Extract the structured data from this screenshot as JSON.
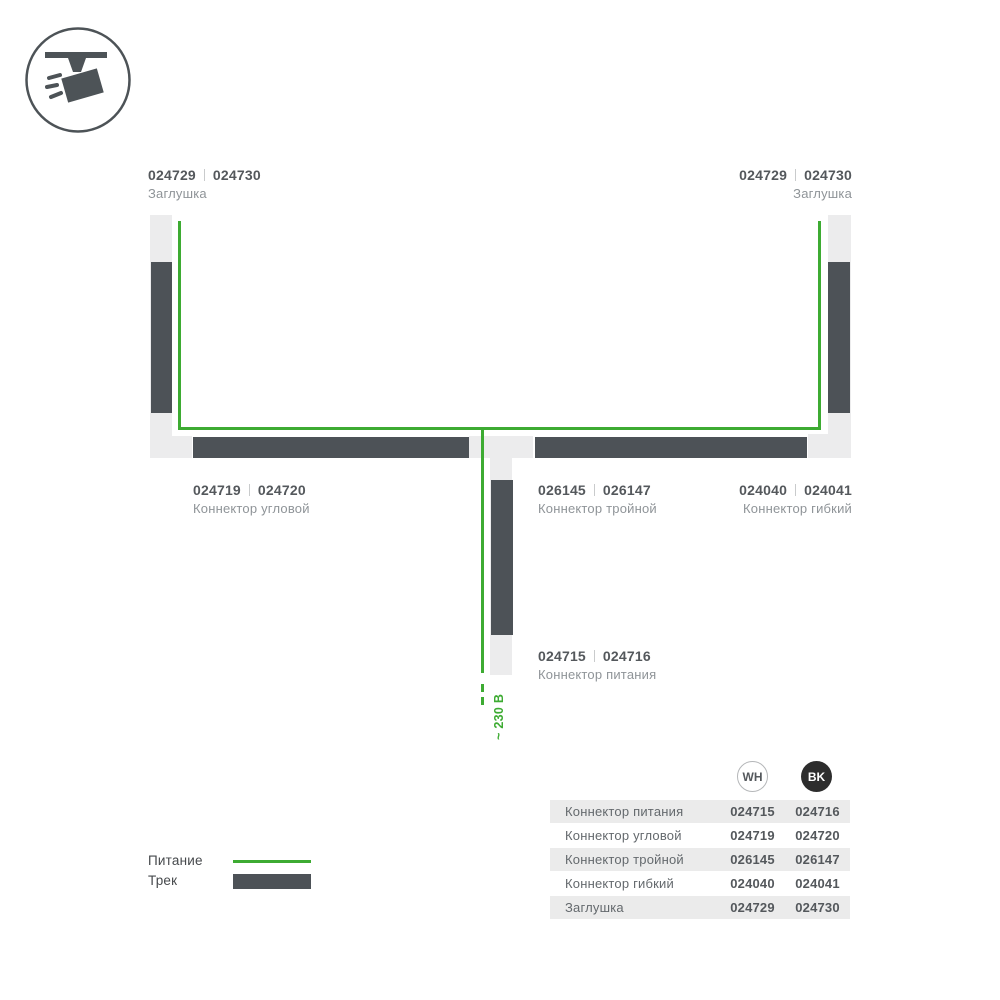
{
  "colors": {
    "track_dark": "#4d5257",
    "channel_light": "#ececed",
    "power_green": "#3dab32",
    "bk_circle": "#2d2d2d",
    "row_shading": "#ebebeb"
  },
  "icon": {
    "name": "track-spotlight"
  },
  "diagram": {
    "labels": {
      "endcap_top_left": {
        "code_wh": "024729",
        "code_bk": "024730",
        "name": "Заглушка"
      },
      "endcap_top_right": {
        "code_wh": "024729",
        "code_bk": "024730",
        "name": "Заглушка"
      },
      "corner": {
        "code_wh": "024719",
        "code_bk": "024720",
        "name": "Коннектор угловой"
      },
      "triple": {
        "code_wh": "026145",
        "code_bk": "026147",
        "name": "Коннектор тройной"
      },
      "flex": {
        "code_wh": "024040",
        "code_bk": "024041",
        "name": "Коннектор гибкий"
      },
      "power": {
        "code_wh": "024715",
        "code_bk": "024716",
        "name": "Коннектор питания"
      }
    },
    "voltage_label": "~ 230 В"
  },
  "legend": {
    "power": "Питание",
    "track": "Трек"
  },
  "table": {
    "columns": [
      {
        "id": "wh",
        "label": "WH"
      },
      {
        "id": "bk",
        "label": "BK"
      }
    ],
    "rows": [
      {
        "name": "Коннектор питания",
        "wh": "024715",
        "bk": "024716"
      },
      {
        "name": "Коннектор угловой",
        "wh": "024719",
        "bk": "024720"
      },
      {
        "name": "Коннектор тройной",
        "wh": "026145",
        "bk": "026147"
      },
      {
        "name": "Коннектор гибкий",
        "wh": "024040",
        "bk": "024041"
      },
      {
        "name": "Заглушка",
        "wh": "024729",
        "bk": "024730"
      }
    ]
  }
}
